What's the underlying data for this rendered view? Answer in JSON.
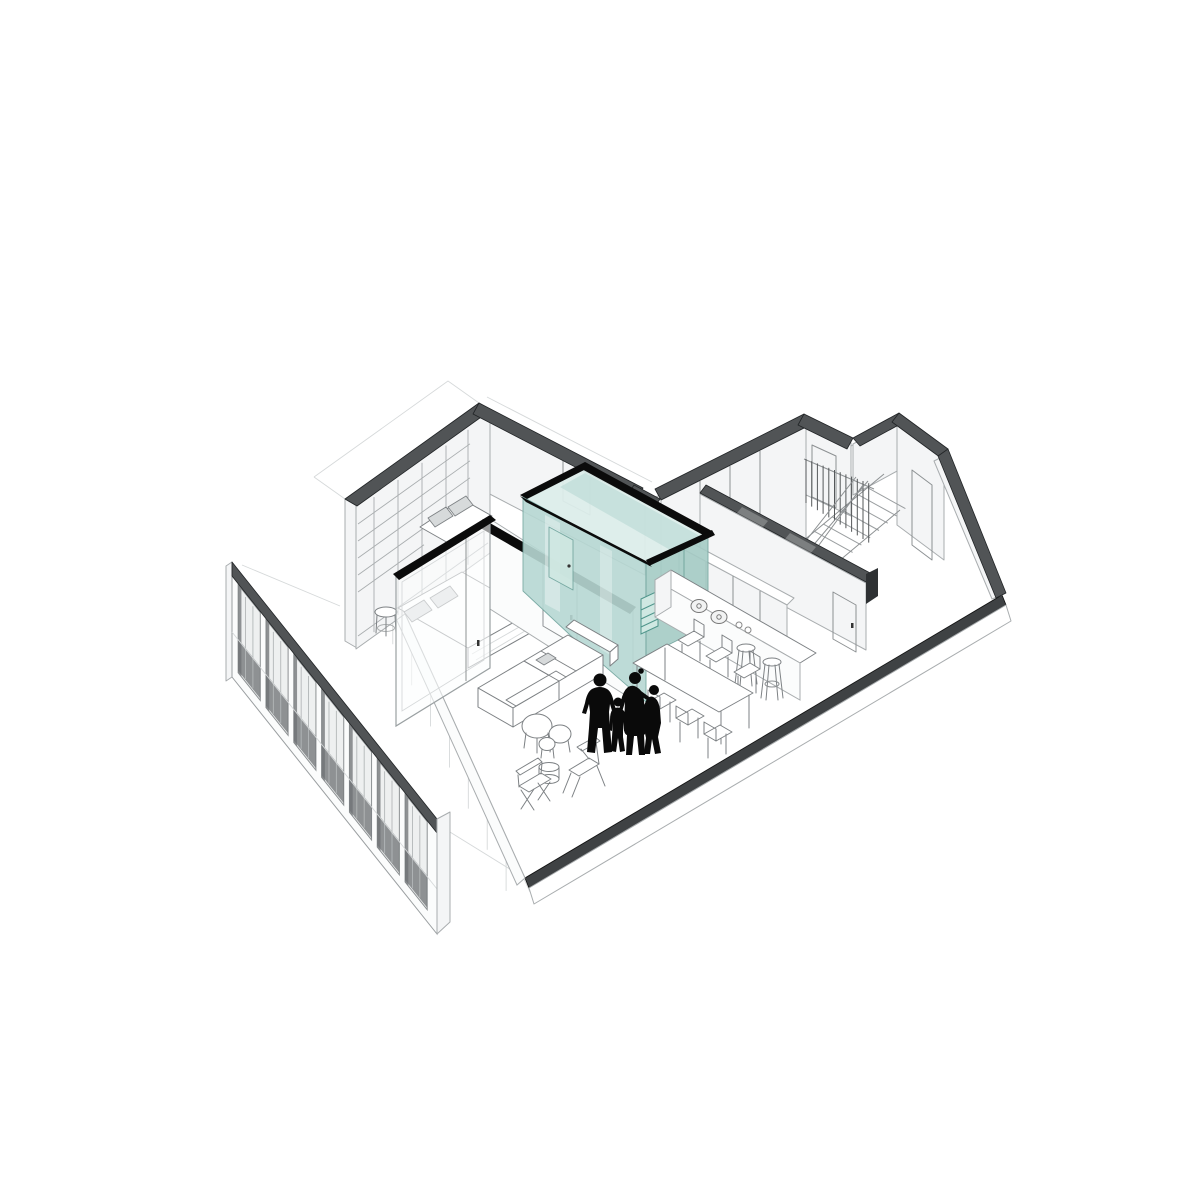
{
  "meta": {
    "title": "Axonometric cutaway drawing of an apartment interior",
    "drawing_type": "architectural-axonometric-cutaway",
    "text_content": "none"
  },
  "palette": {
    "background": "#ffffff",
    "line": "#a9adaf",
    "line_mid": "#8d9193",
    "line_faint": "#d6d9da",
    "wall_face": "#f4f5f6",
    "wall_face_bright": "#fbfcfc",
    "cap_gray": "#515456",
    "cap_dark": "#3f4244",
    "cap_end": "#2e3133",
    "ink": "#212426",
    "black": "#0b0b0b",
    "teal_top": "#dcedea",
    "teal_mid": "#b7d8d3",
    "teal_deep": "#a5cbc5",
    "teal_edge": "#6fa39c",
    "teal_niche": "#cfe8e2",
    "teal_niche_edge": "#4f958b",
    "fur_stroke": "#7d8184",
    "fur_fill": "#ffffff",
    "pillow": "#d7dadb",
    "silhouette": "#0a0a0a",
    "glass": "rgba(252,253,253,0.6)"
  },
  "scene": {
    "rooms": [
      {
        "name": "bedroom"
      },
      {
        "name": "living-room"
      },
      {
        "name": "kitchen"
      },
      {
        "name": "bathroom-core",
        "highlight": "teal-glass"
      },
      {
        "name": "stair-hall"
      },
      {
        "name": "entry-room"
      }
    ],
    "people": {
      "count": 4,
      "figures": [
        "man",
        "child",
        "woman",
        "teenager"
      ]
    },
    "facade": {
      "bay_count": 7
    },
    "stair": {
      "baluster_count": 12,
      "tread_count": 9
    },
    "shelving": {
      "column_lines": 5,
      "shelf_lines": 5
    },
    "sw_wall_ghost_lines": 8,
    "furniture": [
      "bed",
      "daybed",
      "wardrobe-shelving",
      "stool",
      "sofa-sectional",
      "nesting-coffee-tables",
      "side-table",
      "directors-chair",
      "folding-chair",
      "kitchen-island",
      "cooktop",
      "bar-stools",
      "dining-table",
      "dining-chairs"
    ]
  }
}
